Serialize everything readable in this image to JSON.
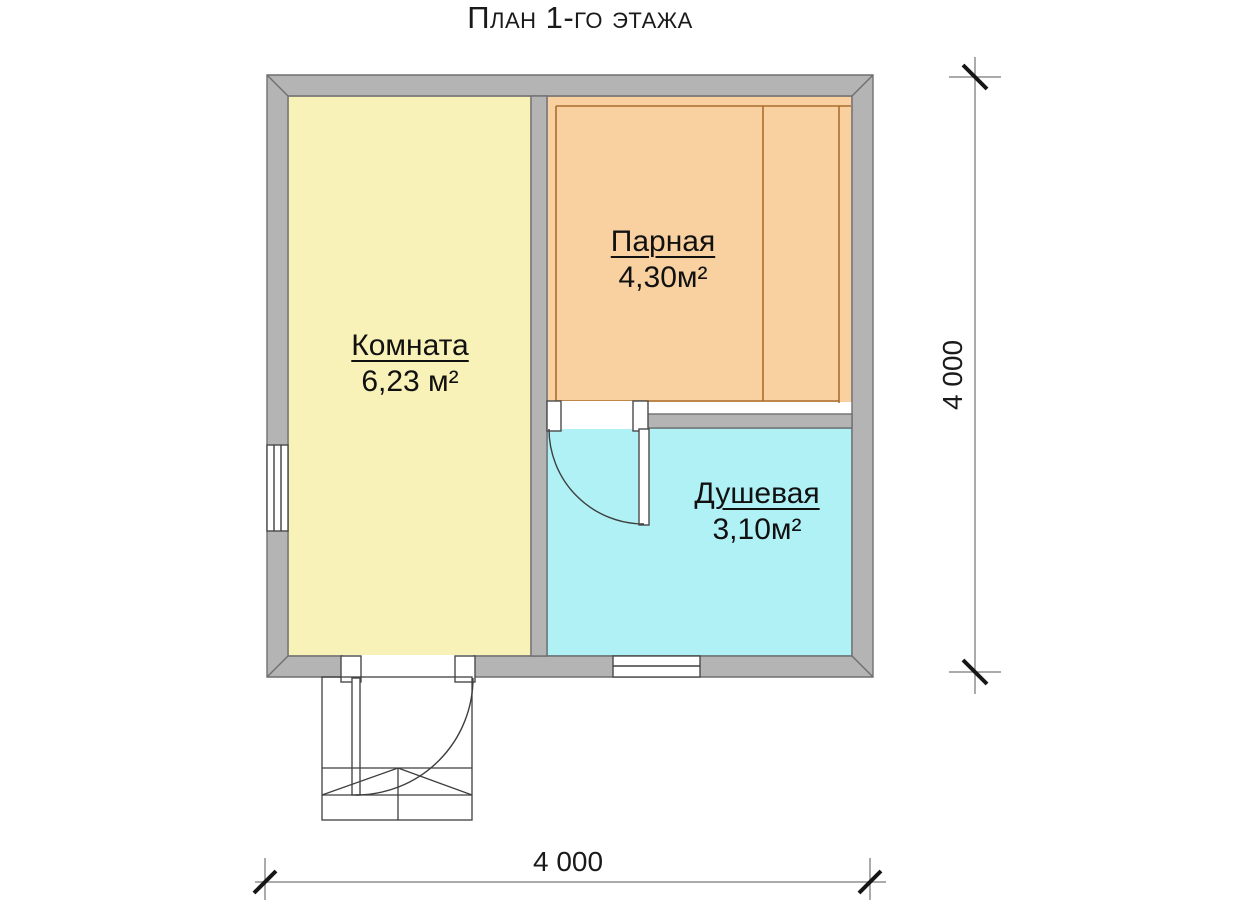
{
  "title": "План 1-го этажа",
  "rooms": {
    "komnata": {
      "name": "Комната",
      "area": "6,23 м²"
    },
    "parnaya": {
      "name": "Парная",
      "area": "4,30м²"
    },
    "dushevaya": {
      "name": "Душевая",
      "area": "3,10м²"
    }
  },
  "dimensions": {
    "bottom": "4 000",
    "right": "4 000"
  },
  "colors": {
    "komnata_fill": "#f9f2b8",
    "parnaya_fill": "#f9d0a0",
    "dushevaya_fill": "#b0f1f5",
    "wall_fill": "#b4b4b4",
    "parnaya_lines": "#aa6d2d",
    "dushevaya_border": "#4f949b"
  }
}
